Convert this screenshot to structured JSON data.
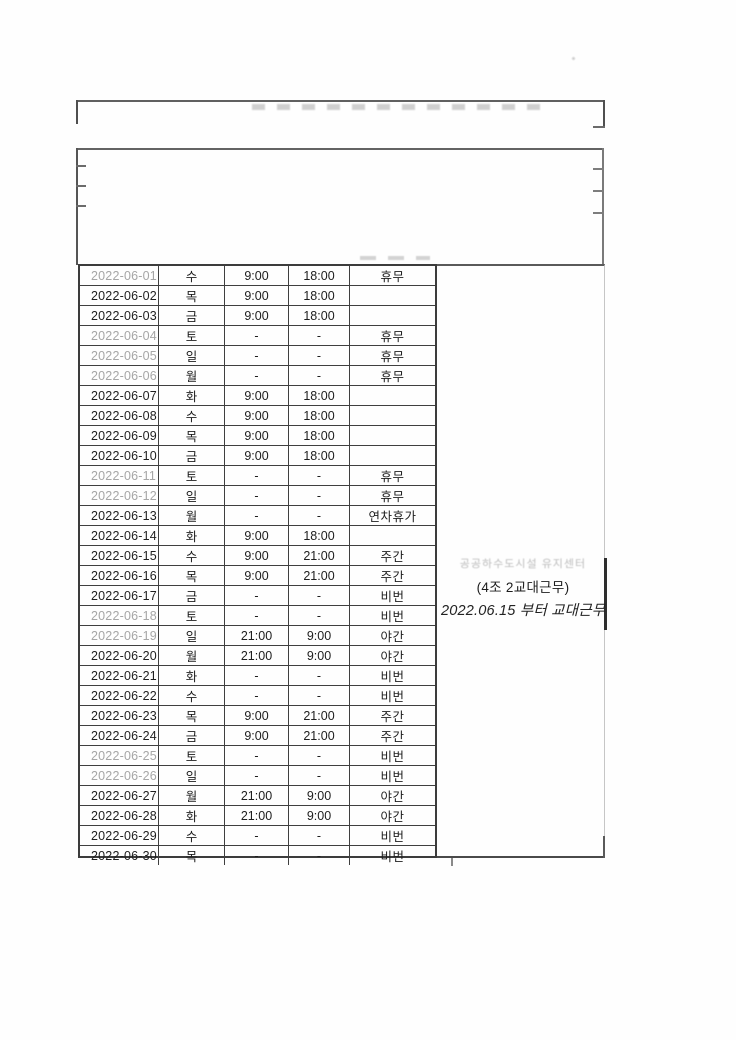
{
  "annotation": {
    "faint_line": "공공하수도시설 유지센터",
    "team_line": "(4조 2교대근무)",
    "date_line": "2022.06.15 부터 교대근무"
  },
  "table": {
    "columns": [
      "date",
      "day",
      "start_time",
      "end_time",
      "status"
    ],
    "rows": [
      {
        "date": "2022-06-01",
        "day": "수",
        "start": "9:00",
        "end": "18:00",
        "status": "휴무",
        "holiday": true
      },
      {
        "date": "2022-06-02",
        "day": "목",
        "start": "9:00",
        "end": "18:00",
        "status": "",
        "holiday": false
      },
      {
        "date": "2022-06-03",
        "day": "금",
        "start": "9:00",
        "end": "18:00",
        "status": "",
        "holiday": false
      },
      {
        "date": "2022-06-04",
        "day": "토",
        "start": "-",
        "end": "-",
        "status": "휴무",
        "holiday": true
      },
      {
        "date": "2022-06-05",
        "day": "일",
        "start": "-",
        "end": "-",
        "status": "휴무",
        "holiday": true
      },
      {
        "date": "2022-06-06",
        "day": "월",
        "start": "-",
        "end": "-",
        "status": "휴무",
        "holiday": true
      },
      {
        "date": "2022-06-07",
        "day": "화",
        "start": "9:00",
        "end": "18:00",
        "status": "",
        "holiday": false
      },
      {
        "date": "2022-06-08",
        "day": "수",
        "start": "9:00",
        "end": "18:00",
        "status": "",
        "holiday": false
      },
      {
        "date": "2022-06-09",
        "day": "목",
        "start": "9:00",
        "end": "18:00",
        "status": "",
        "holiday": false
      },
      {
        "date": "2022-06-10",
        "day": "금",
        "start": "9:00",
        "end": "18:00",
        "status": "",
        "holiday": false
      },
      {
        "date": "2022-06-11",
        "day": "토",
        "start": "-",
        "end": "-",
        "status": "휴무",
        "holiday": true
      },
      {
        "date": "2022-06-12",
        "day": "일",
        "start": "-",
        "end": "-",
        "status": "휴무",
        "holiday": true
      },
      {
        "date": "2022-06-13",
        "day": "월",
        "start": "-",
        "end": "-",
        "status": "연차휴가",
        "holiday": false
      },
      {
        "date": "2022-06-14",
        "day": "화",
        "start": "9:00",
        "end": "18:00",
        "status": "",
        "holiday": false
      },
      {
        "date": "2022-06-15",
        "day": "수",
        "start": "9:00",
        "end": "21:00",
        "status": "주간",
        "holiday": false
      },
      {
        "date": "2022-06-16",
        "day": "목",
        "start": "9:00",
        "end": "21:00",
        "status": "주간",
        "holiday": false
      },
      {
        "date": "2022-06-17",
        "day": "금",
        "start": "-",
        "end": "-",
        "status": "비번",
        "holiday": false
      },
      {
        "date": "2022-06-18",
        "day": "토",
        "start": "-",
        "end": "-",
        "status": "비번",
        "holiday": true
      },
      {
        "date": "2022-06-19",
        "day": "일",
        "start": "21:00",
        "end": "9:00",
        "status": "야간",
        "holiday": true
      },
      {
        "date": "2022-06-20",
        "day": "월",
        "start": "21:00",
        "end": "9:00",
        "status": "야간",
        "holiday": false
      },
      {
        "date": "2022-06-21",
        "day": "화",
        "start": "-",
        "end": "-",
        "status": "비번",
        "holiday": false
      },
      {
        "date": "2022-06-22",
        "day": "수",
        "start": "-",
        "end": "-",
        "status": "비번",
        "holiday": false
      },
      {
        "date": "2022-06-23",
        "day": "목",
        "start": "9:00",
        "end": "21:00",
        "status": "주간",
        "holiday": false
      },
      {
        "date": "2022-06-24",
        "day": "금",
        "start": "9:00",
        "end": "21:00",
        "status": "주간",
        "holiday": false
      },
      {
        "date": "2022-06-25",
        "day": "토",
        "start": "-",
        "end": "-",
        "status": "비번",
        "holiday": true
      },
      {
        "date": "2022-06-26",
        "day": "일",
        "start": "-",
        "end": "-",
        "status": "비번",
        "holiday": true
      },
      {
        "date": "2022-06-27",
        "day": "월",
        "start": "21:00",
        "end": "9:00",
        "status": "야간",
        "holiday": false
      },
      {
        "date": "2022-06-28",
        "day": "화",
        "start": "21:00",
        "end": "9:00",
        "status": "야간",
        "holiday": false
      },
      {
        "date": "2022-06-29",
        "day": "수",
        "start": "-",
        "end": "-",
        "status": "비번",
        "holiday": false
      },
      {
        "date": "2022-06-30",
        "day": "목",
        "start": "-",
        "end": "-",
        "status": "비번",
        "holiday": false
      }
    ]
  },
  "colors": {
    "table_grid": "#3c3c3c",
    "text_ink": "#1e1e1e",
    "holiday_date": "#a6a6a6",
    "faint_erased_ink": "#bcbcbc"
  }
}
